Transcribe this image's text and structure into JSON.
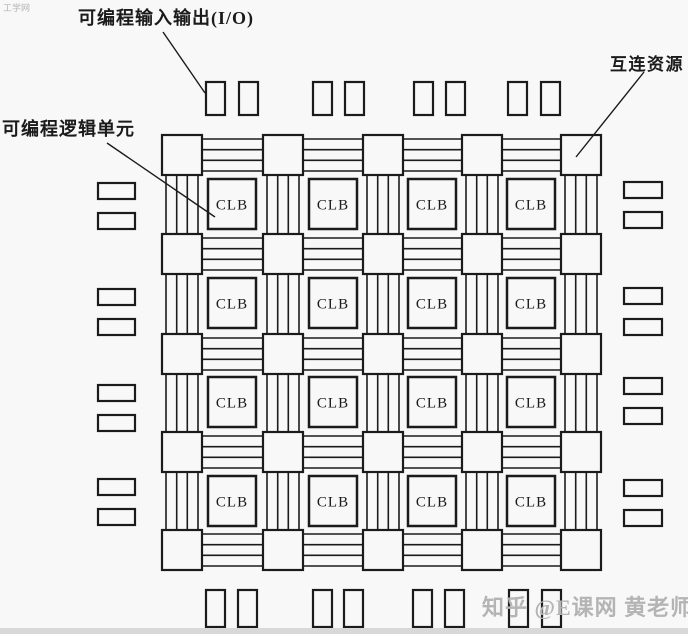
{
  "figure_title": "FPGA architecture diagram",
  "clb_label": "CLB",
  "labels": {
    "programmable_io": "可编程输入输出(I/O)",
    "programmable_logic_cell": "可编程逻辑单元",
    "interconnect_resources": "互连资源"
  },
  "watermarks": {
    "top_left": "工学网",
    "bottom_right": "知乎 @E课网 黄老师"
  },
  "colors": {
    "line": "#1b1b1b",
    "background": "#f8f8f8",
    "watermark": "#b4b4b4",
    "bottom_bar": "#d8d8d8"
  },
  "diagram": {
    "type": "fpga-grid",
    "switch_cols_x": [
      162,
      263,
      363,
      462,
      561
    ],
    "switch_rows_y": [
      135,
      234,
      334,
      432,
      530
    ],
    "switch_size": 40,
    "channel_line_offsets": [
      4,
      14.7,
      25.3,
      36
    ],
    "clb_cols_x": [
      208,
      309,
      408,
      507
    ],
    "clb_rows_y": [
      179,
      278,
      377,
      476
    ],
    "clb_w": 48,
    "clb_h": 50,
    "io_top": {
      "y": 82,
      "w": 19,
      "h": 33,
      "pairs_x": [
        [
          206,
          239
        ],
        [
          313,
          345
        ],
        [
          414,
          446
        ],
        [
          508,
          541
        ]
      ]
    },
    "io_bottom": {
      "y": 590,
      "w": 19,
      "h": 37,
      "pairs_x": [
        [
          206,
          238
        ],
        [
          313,
          344
        ],
        [
          413,
          445
        ],
        [
          509,
          542
        ]
      ]
    },
    "io_left": {
      "x": 98,
      "w": 37,
      "h": 16,
      "pairs_y": [
        [
          183,
          213
        ],
        [
          289,
          319
        ],
        [
          385,
          415
        ],
        [
          479,
          509
        ]
      ]
    },
    "io_right": {
      "x": 624,
      "w": 38,
      "h": 16,
      "pairs_y": [
        [
          182,
          212
        ],
        [
          288,
          319
        ],
        [
          378,
          408
        ],
        [
          480,
          510
        ]
      ]
    },
    "leader_lines": [
      {
        "name": "io-leader-line",
        "x1": 163,
        "y1": 32,
        "x2": 205,
        "y2": 93
      },
      {
        "name": "clb-leader-line",
        "x1": 107,
        "y1": 143,
        "x2": 215,
        "y2": 217
      },
      {
        "name": "interconnect-leader-line",
        "x1": 644,
        "y1": 72,
        "x2": 576,
        "y2": 157
      }
    ]
  }
}
